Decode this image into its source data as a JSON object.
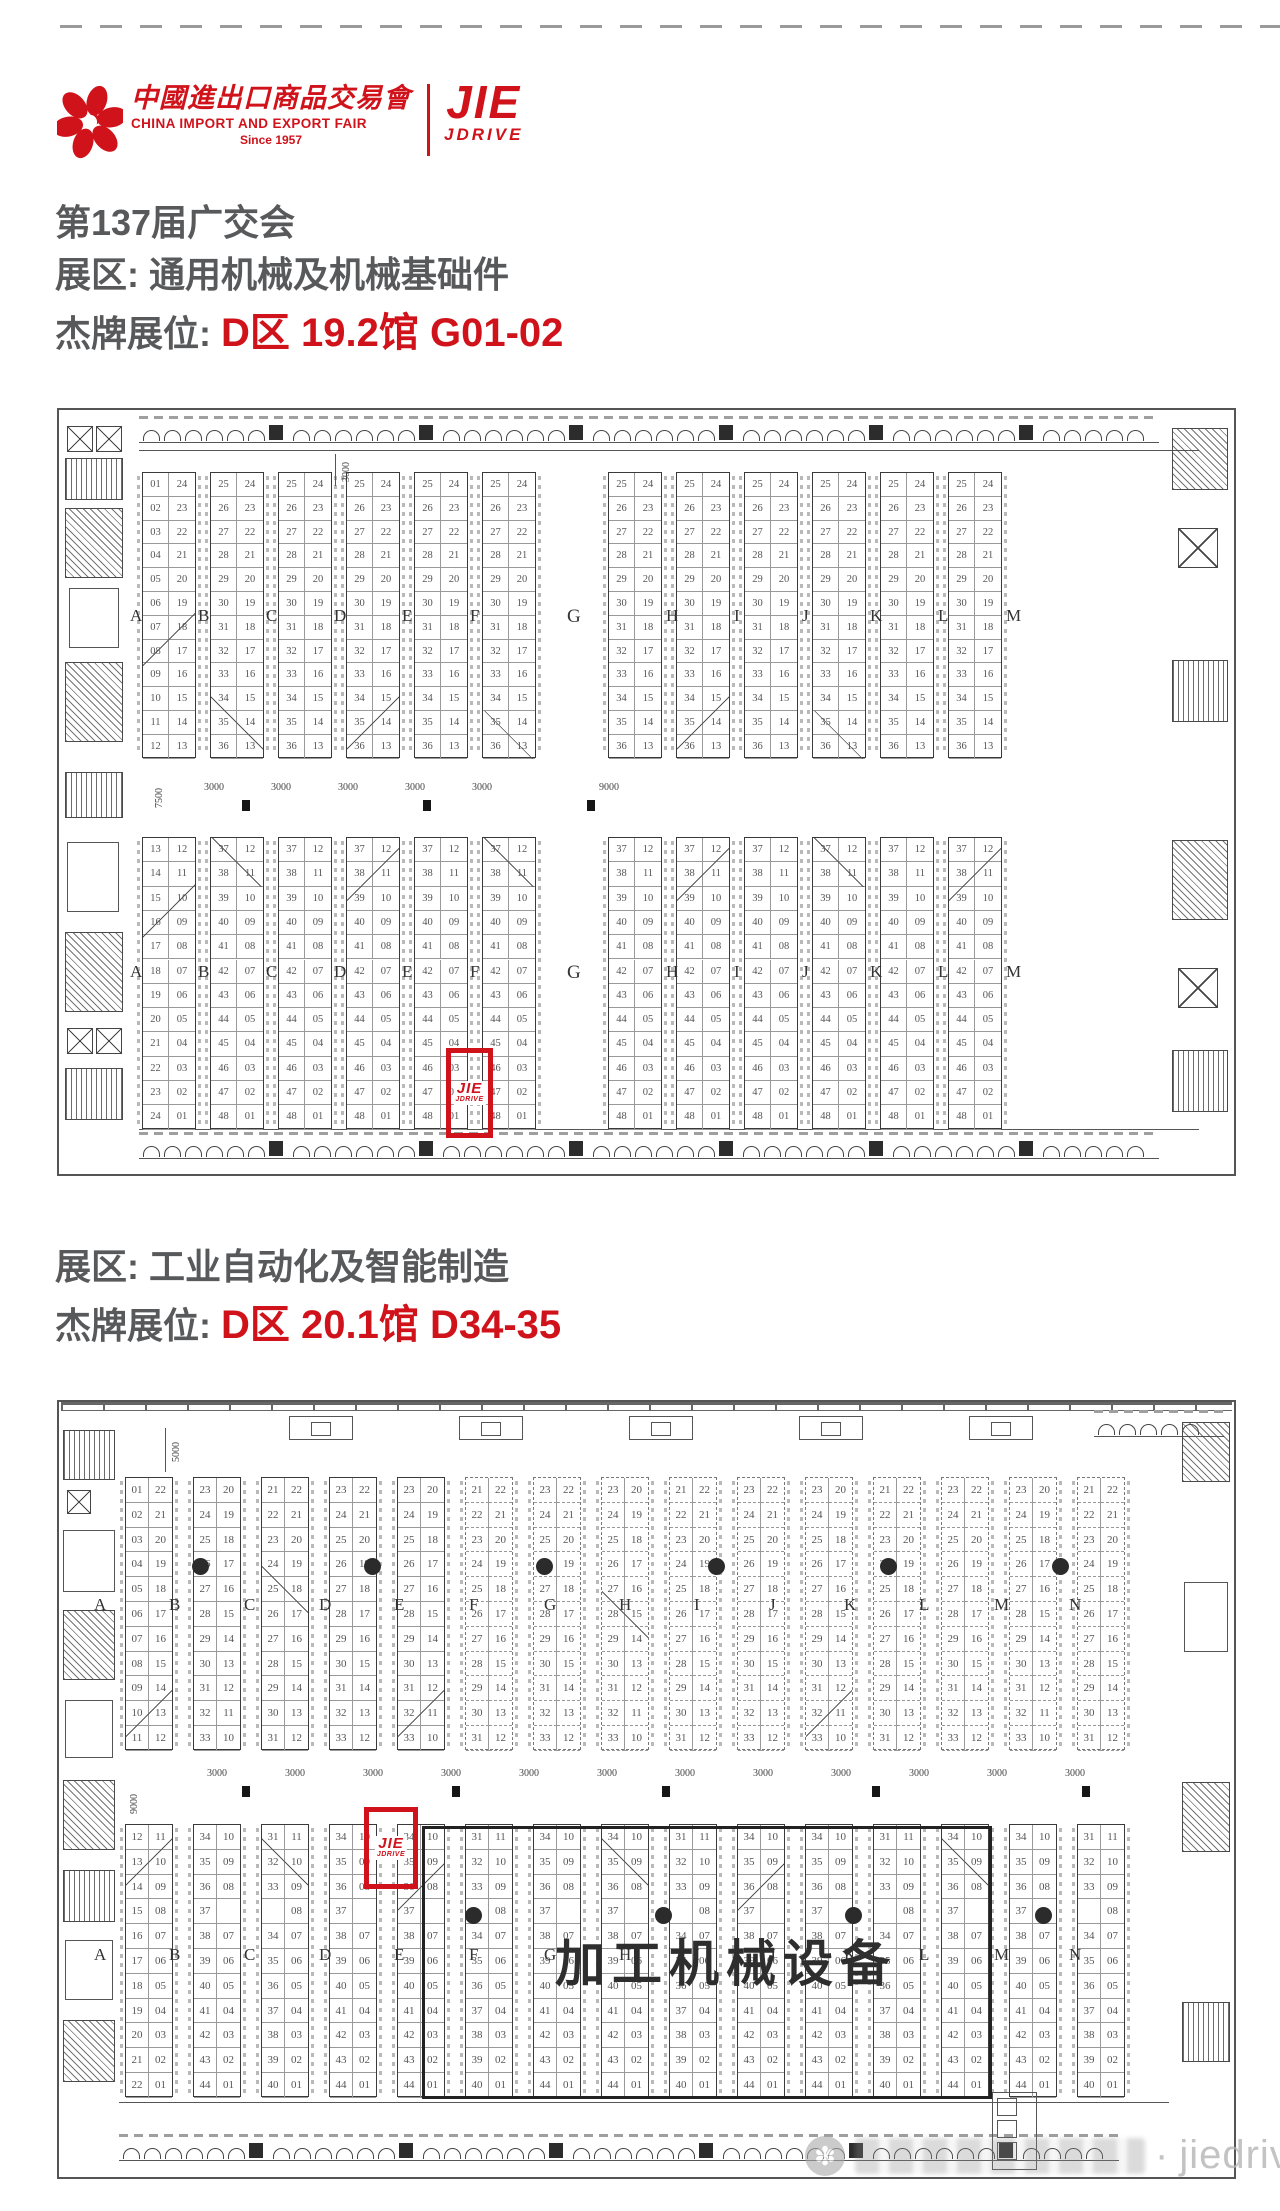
{
  "page": {
    "bg": "#ffffff",
    "accent_red": "#d0121b",
    "heading_gray": "#58595b",
    "plan_line": "#444444",
    "plan_number_gray": "#555555",
    "watermark_gray": "#b5b5b5"
  },
  "header": {
    "fair_logo": {
      "cn": "中國進出口商品交易會",
      "en": "CHINA IMPORT AND EXPORT FAIR",
      "since": "Since 1957"
    },
    "brand": {
      "line1": "JIE",
      "line2": "JDRIVE"
    }
  },
  "headings": {
    "title": "第137届广交会",
    "zone1_label": "展区: 通用机械及机械基础件",
    "booth1_label": "杰牌展位: ",
    "booth1_value": "D区 19.2馆 G01-02",
    "zone2_label": "展区: 工业自动化及智能制造",
    "booth2_label": "杰牌展位: ",
    "booth2_value": "D区 20.1馆 D34-35"
  },
  "map1": {
    "letters_left": [
      "A",
      "B",
      "C",
      "D",
      "E",
      "F"
    ],
    "letter_center": "G",
    "letters_right": [
      "H",
      "I",
      "J",
      "K",
      "L",
      "M"
    ],
    "patterns": {
      "upper_first": {
        "col1": [
          "01",
          "02",
          "03",
          "04",
          "05",
          "06",
          "07",
          "08",
          "09",
          "10",
          "11",
          "12"
        ],
        "col2": [
          "24",
          "23",
          "22",
          "21",
          "20",
          "19",
          "18",
          "17",
          "16",
          "15",
          "14",
          "13"
        ]
      },
      "upper_std": {
        "col1": [
          "25",
          "26",
          "27",
          "28",
          "29",
          "30",
          "31",
          "32",
          "33",
          "34",
          "35",
          "36"
        ],
        "col2": [
          "24",
          "23",
          "22",
          "21",
          "20",
          "19",
          "18",
          "17",
          "16",
          "15",
          "14",
          "13"
        ]
      },
      "lower_first": {
        "col1": [
          "13",
          "14",
          "15",
          "16",
          "17",
          "18",
          "19",
          "20",
          "21",
          "22",
          "23",
          "24"
        ],
        "col2": [
          "12",
          "11",
          "10",
          "09",
          "08",
          "07",
          "06",
          "05",
          "04",
          "03",
          "02",
          "01"
        ]
      },
      "lower_std": {
        "col1": [
          "37",
          "38",
          "39",
          "40",
          "41",
          "42",
          "43",
          "44",
          "45",
          "46",
          "47",
          "48"
        ],
        "col2": [
          "12",
          "11",
          "10",
          "09",
          "08",
          "07",
          "06",
          "05",
          "04",
          "03",
          "02",
          "01"
        ]
      }
    },
    "dims": {
      "aisle_labels": [
        "3000",
        "3000",
        "3000",
        "3000",
        "3000"
      ],
      "aisle_big": "9000",
      "left_vertical": "7500",
      "top_vertical": "3000"
    },
    "highlight": {
      "booth": "G01-02",
      "logo1": "JIE",
      "logo2": "JDRIVE"
    }
  },
  "map2": {
    "letters": [
      "A",
      "B",
      "C",
      "D",
      "E",
      "F",
      "G",
      "H",
      "I",
      "J",
      "K",
      "L",
      "M",
      "N"
    ],
    "patterns": {
      "upper_first": {
        "col1": [
          "01",
          "02",
          "03",
          "04",
          "05",
          "06",
          "07",
          "08",
          "09",
          "10",
          "11"
        ],
        "col2": [
          "22",
          "21",
          "20",
          "19",
          "18",
          "17",
          "16",
          "15",
          "14",
          "13",
          "12"
        ]
      },
      "upper_a": {
        "col1": [
          "23",
          "24",
          "25",
          "26",
          "27",
          "28",
          "29",
          "30",
          "31",
          "32",
          "33"
        ],
        "col2": [
          "20",
          "19",
          "18",
          "17",
          "16",
          "15",
          "14",
          "13",
          "12",
          "11",
          "10"
        ]
      },
      "upper_b": {
        "col1": [
          "21",
          "22",
          "23",
          "24",
          "25",
          "26",
          "27",
          "28",
          "29",
          "30",
          "31"
        ],
        "col2": [
          "22",
          "21",
          "20",
          "19",
          "18",
          "17",
          "16",
          "15",
          "14",
          "13",
          "12"
        ]
      },
      "upper_c": {
        "col1": [
          "23",
          "24",
          "25",
          "26",
          "27",
          "28",
          "29",
          "30",
          "31",
          "32",
          "33"
        ],
        "col2": [
          "22",
          "21",
          "20",
          "19",
          "18",
          "17",
          "16",
          "15",
          "14",
          "13",
          "12"
        ]
      },
      "lower_first": {
        "col1": [
          "12",
          "13",
          "14",
          "15",
          "16",
          "17",
          "18",
          "19",
          "20",
          "21",
          "22"
        ],
        "col2": [
          "11",
          "10",
          "09",
          "08",
          "07",
          "06",
          "05",
          "04",
          "03",
          "02",
          "01"
        ]
      },
      "lower_a": {
        "col1": [
          "34",
          "35",
          "36",
          "37",
          "38",
          "39",
          "40",
          "41",
          "42",
          "43",
          "44"
        ],
        "col2": [
          "10",
          "09",
          "08",
          "",
          "07",
          "06",
          "05",
          "04",
          "03",
          "02",
          "01"
        ]
      },
      "lower_b": {
        "col1": [
          "31",
          "32",
          "33",
          "",
          "34",
          "35",
          "36",
          "37",
          "38",
          "39",
          "40"
        ],
        "col2": [
          "11",
          "10",
          "09",
          "08",
          "07",
          "06",
          "05",
          "04",
          "03",
          "02",
          "01"
        ]
      }
    },
    "zone_big_label": "加工机械设备",
    "dims": {
      "aisle_label": "3000",
      "top_vertical": "5000",
      "left_vertical": "9000"
    },
    "highlight": {
      "booth": "D34-35",
      "logo1": "JIE",
      "logo2": "JDRIVE"
    }
  },
  "watermark": {
    "dot": "·",
    "brand": "jiedrive"
  }
}
